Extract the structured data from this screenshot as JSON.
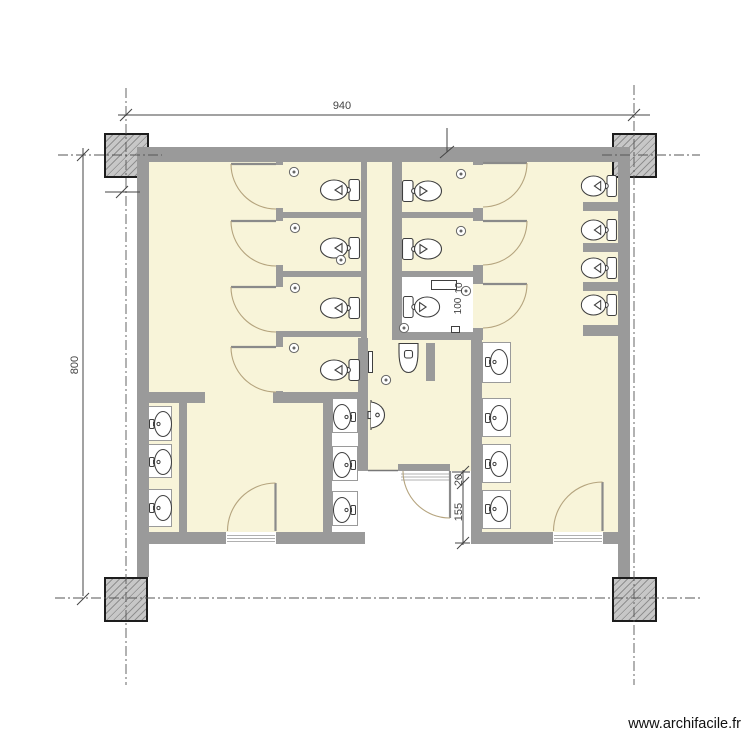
{
  "title": "sanitary-block-floor-plan",
  "dims": {
    "top": "940",
    "left": "800",
    "entry_a": "155",
    "entry_b": "20",
    "stall_a": "100",
    "stall_b": "10"
  },
  "watermark": {
    "text": "www.archifacile.fr"
  },
  "colors": {
    "wall": "#9a9a9a",
    "room": "#f8f4d9",
    "arc": "#b5a47e",
    "colfill": "#c7c7c7",
    "colhatch": "#8f8f8f",
    "colborder": "#1d1d1d",
    "fix": "#3f3f3f",
    "center": "#555555",
    "dim": "#444444",
    "wm": "#111111"
  },
  "fixture_counts": {
    "toilets": 11,
    "sinks": 10,
    "corner_sinks": 1,
    "urinals": 1,
    "doors": 10
  }
}
